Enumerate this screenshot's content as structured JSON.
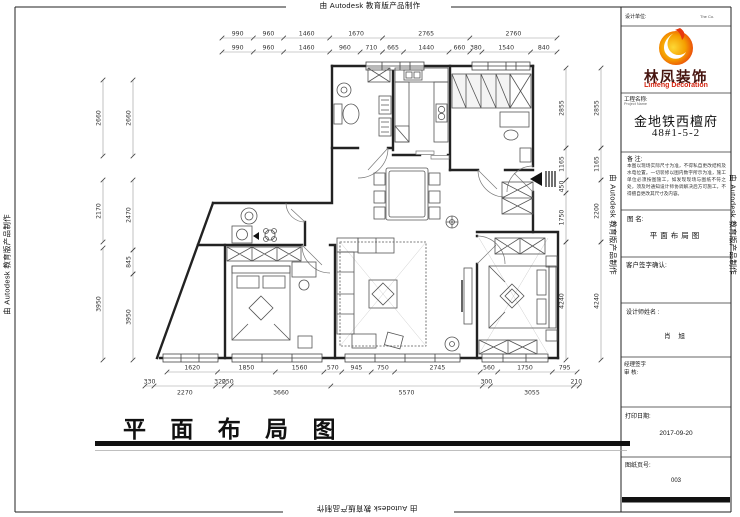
{
  "autodesk_notice": "由 Autodesk 教育版产品制作",
  "main_title": "平 面 布 局 图",
  "title_block": {
    "design_unit_label": "设计单位:",
    "design_unit_right": "The Co.",
    "logo": {
      "cn": "林凤装饰",
      "en": "Linfeng Decoration"
    },
    "project_label": "工程名称:",
    "project_label_en": "Project Name",
    "project_name_line1": "金地铁西檀府",
    "project_name_line2": "48#1-5-2",
    "notes_label": "备  注:",
    "notes_text": "本图以现场实际尺寸为准，不得私自更改结构及水电位置。一切装修以图内数字所示为准，施工单位必须按图施工，如发现现场与图纸不符之处，须及时通知设计师协调解决后方可施工，不得擅自更改其尺寸及内容。",
    "drawing_name_label": "图  名:",
    "drawing_name": "平面布局图",
    "client_sign_label": "客户签字确认:",
    "designer_label": "设计师姓名 :",
    "designer_name": "肖  旭",
    "manager_sign_label": "经理签字",
    "review_label": "审  核:",
    "print_date_label": "打印日期:",
    "print_date": "2017-09-20",
    "page_label": "图纸页号:",
    "page_number": "003"
  },
  "dimensions": {
    "top_row1": [
      "990",
      "960",
      "1460",
      "1670",
      "2765",
      "2760"
    ],
    "top_row2": [
      "990",
      "960",
      "1460",
      "960",
      "710",
      "665",
      "1440",
      "660",
      "380",
      "1540",
      "840"
    ],
    "bottom_row1": [
      "1620",
      "1850",
      "1560",
      "570",
      "945",
      "750",
      "2745",
      "560",
      "1750",
      "795"
    ],
    "bottom_row2": [
      "330",
      "2270",
      "320",
      "250",
      "3660",
      "5570",
      "300",
      "3055",
      "210"
    ],
    "left_col_outer": [
      "2660",
      "2170",
      "3950"
    ],
    "left_col_inner": [
      "2660",
      "2470",
      "845",
      "3950"
    ],
    "right_col_inner": [
      "2855",
      "1165",
      "450",
      "1750",
      "4240"
    ],
    "right_col_outer": [
      "2855",
      "1165",
      "2200",
      "4240"
    ]
  }
}
